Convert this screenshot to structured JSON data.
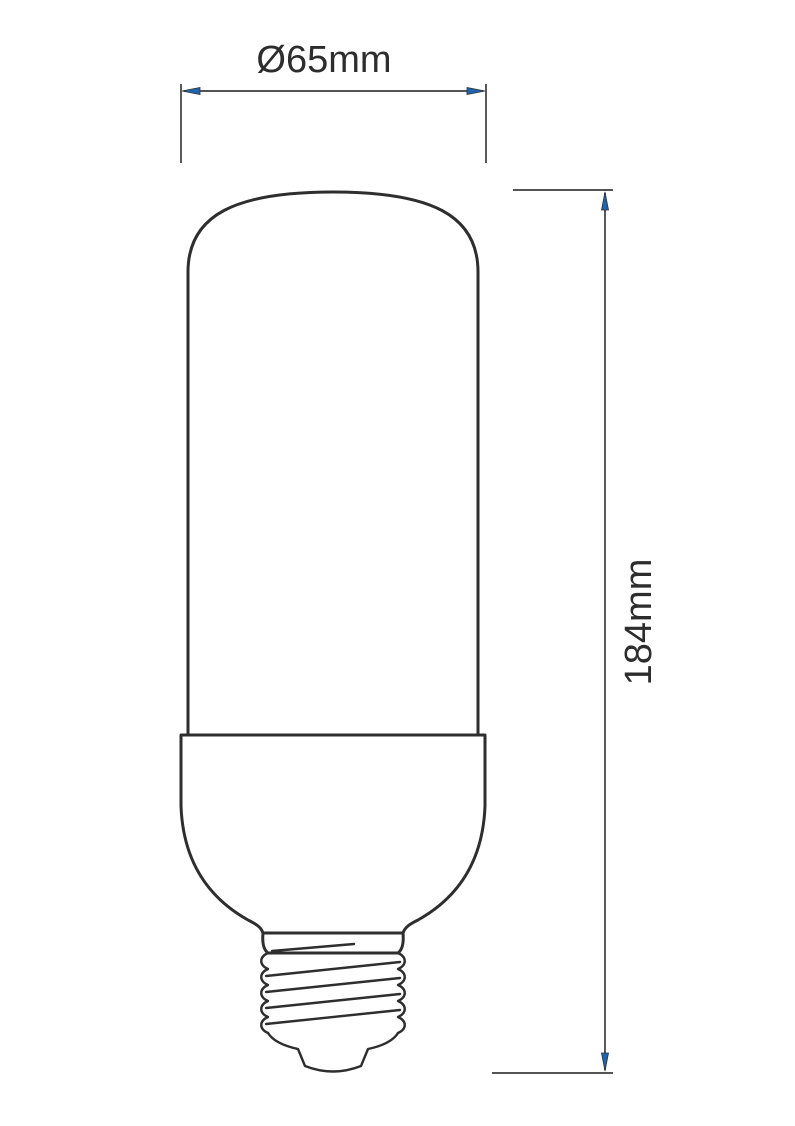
{
  "diagram": {
    "type": "technical-dimension-drawing",
    "subject": "Tubular LED bulb with E27 screw base, front elevation",
    "parts": [
      "glass-tube",
      "housing",
      "collar",
      "screw-threads",
      "contact-tip"
    ],
    "dimensions": {
      "width": {
        "label": "Ø65mm"
      },
      "height": {
        "label": "184mm"
      }
    },
    "colors": {
      "line": "#2e2e2e",
      "dimension_line": "#3c3c3c",
      "arrow_fill": "#1d65b0",
      "text": "#2d2d2d",
      "background": "#ffffff"
    }
  }
}
